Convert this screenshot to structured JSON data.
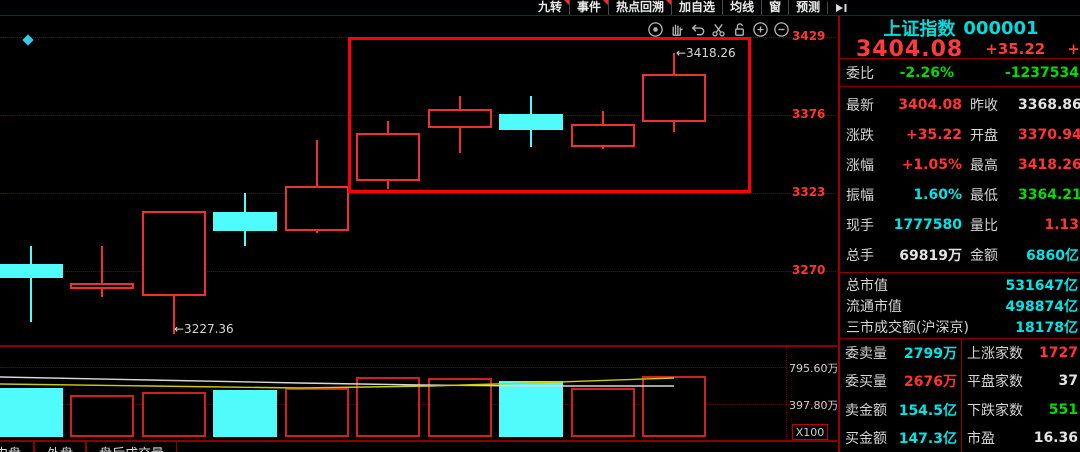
{
  "colors": {
    "red": "#ff3434",
    "green": "#00dc00",
    "cyan": "#00e5e5",
    "white": "#e2e2e2",
    "candle_up": "#f03030",
    "candle_down": "#50fbfb",
    "annotation": "#ff0000",
    "ma_white": "#d8d8d8",
    "ma_yellow": "#cccc00",
    "marker_blue": "#38c8e8"
  },
  "top_menu": {
    "items": [
      {
        "label": "九转",
        "badge": true
      },
      {
        "label": "事件",
        "badge": true
      },
      {
        "label": "热点回溯",
        "badge": true
      },
      {
        "label": "加自选",
        "badge": false
      },
      {
        "label": "均线",
        "badge": false
      },
      {
        "label": "窗",
        "badge": false
      },
      {
        "label": "预测",
        "badge": false
      }
    ],
    "collapse_icon": "arrow-to-bar-icon"
  },
  "chart_toolbar": {
    "icons": [
      "eye-icon",
      "hand-icon",
      "undo-icon",
      "scissors-icon",
      "unlock-icon",
      "zoom-in-icon",
      "zoom-out-icon"
    ]
  },
  "chart_data": {
    "type": "candlestick",
    "price_axis": {
      "ticks": [
        3429,
        3376,
        3323,
        3270
      ]
    },
    "volume_axis": {
      "ticks": [
        "795.60万",
        "397.80万"
      ],
      "tick_values": [
        795.6,
        397.8
      ],
      "scale_label": "X100"
    },
    "candles": [
      {
        "open": 3275,
        "close": 3265,
        "high": 3287,
        "low": 3235
      },
      {
        "open": 3258,
        "close": 3262,
        "high": 3287,
        "low": 3252
      },
      {
        "open": 3253,
        "close": 3311,
        "high": 3311,
        "low": 3227.36
      },
      {
        "open": 3310,
        "close": 3297,
        "high": 3323,
        "low": 3287
      },
      {
        "open": 3297,
        "close": 3328,
        "high": 3359,
        "low": 3296
      },
      {
        "open": 3331,
        "close": 3364,
        "high": 3372,
        "low": 3326
      },
      {
        "open": 3367,
        "close": 3380,
        "high": 3389,
        "low": 3350
      },
      {
        "open": 3377,
        "close": 3366,
        "high": 3389,
        "low": 3354
      },
      {
        "open": 3354,
        "close": 3370,
        "high": 3379,
        "low": 3353
      },
      {
        "open": 3370.94,
        "close": 3404.08,
        "high": 3418.26,
        "low": 3364.21
      }
    ],
    "volumes": [
      570,
      495,
      527,
      548,
      570,
      688,
      680,
      645,
      570,
      698
    ],
    "ma_lines": {
      "white": [
        [
          0,
          377
        ],
        [
          150,
          380
        ],
        [
          300,
          383
        ],
        [
          420,
          385
        ],
        [
          530,
          386
        ],
        [
          674,
          386
        ]
      ],
      "yellow": [
        [
          0,
          384
        ],
        [
          150,
          386
        ],
        [
          300,
          388
        ],
        [
          430,
          386
        ],
        [
          530,
          383
        ],
        [
          674,
          378
        ]
      ]
    },
    "annotations": {
      "box": {
        "x": 348,
        "y": 37,
        "w": 403,
        "h": 156
      },
      "high_label": {
        "text": "3418.26",
        "x": 676,
        "y": 46
      },
      "low_label": {
        "text": "3227.36",
        "x": 174,
        "y": 322
      },
      "marker": {
        "type": "diamond",
        "x": 24,
        "y": 36
      }
    }
  },
  "panel": {
    "title": "上证指数",
    "code": "000001",
    "price": "3404.08",
    "change": "+35.22",
    "change_pct": "+1.05%",
    "weibi_row": {
      "label": "委比",
      "value": "-2.26%",
      "value_color": "green",
      "value2": "-1237534",
      "value2_color": "green"
    },
    "quote_rows": [
      {
        "l": "最新",
        "lv": "3404.08",
        "lc": "red",
        "r": "昨收",
        "rv": "3368.86",
        "rc": "white"
      },
      {
        "l": "涨跌",
        "lv": "+35.22",
        "lc": "red",
        "r": "开盘",
        "rv": "3370.94",
        "rc": "red"
      },
      {
        "l": "涨幅",
        "lv": "+1.05%",
        "lc": "red",
        "r": "最高",
        "rv": "3418.26",
        "rc": "red"
      },
      {
        "l": "振幅",
        "lv": "1.60%",
        "lc": "cyan",
        "r": "最低",
        "rv": "3364.21",
        "rc": "green"
      },
      {
        "l": "现手",
        "lv": "1777580",
        "lc": "cyan",
        "r": "量比",
        "rv": "1.13",
        "rc": "red"
      },
      {
        "l": "总手",
        "lv": "69819万",
        "lc": "white",
        "r": "金额",
        "rv": "6860亿",
        "rc": "cyan"
      }
    ],
    "market_rows": [
      {
        "label": "总市值",
        "value": "531647亿",
        "color": "cyan"
      },
      {
        "label": "流通市值",
        "value": "498874亿",
        "color": "cyan"
      },
      {
        "label": "三市成交额(沪深京)",
        "value": "18178亿",
        "color": "cyan"
      }
    ],
    "order_rows": [
      {
        "label": "委卖量",
        "value": "2799万",
        "color": "cyan"
      },
      {
        "label": "委买量",
        "value": "2676万",
        "color": "red"
      },
      {
        "label": "卖金额",
        "value": "154.5亿",
        "color": "cyan"
      },
      {
        "label": "买金额",
        "value": "147.3亿",
        "color": "cyan"
      }
    ],
    "breadth_rows": [
      {
        "label": "上涨家数",
        "value": "1727",
        "color": "red"
      },
      {
        "label": "平盘家数",
        "value": "37",
        "color": "white"
      },
      {
        "label": "下跌家数",
        "value": "551",
        "color": "green"
      },
      {
        "label": "市盈",
        "value": "16.36",
        "color": "white"
      }
    ]
  },
  "bottom_tabs": [
    {
      "label": "内盘"
    },
    {
      "label": "外盘"
    },
    {
      "label": "盘后成交量"
    }
  ]
}
